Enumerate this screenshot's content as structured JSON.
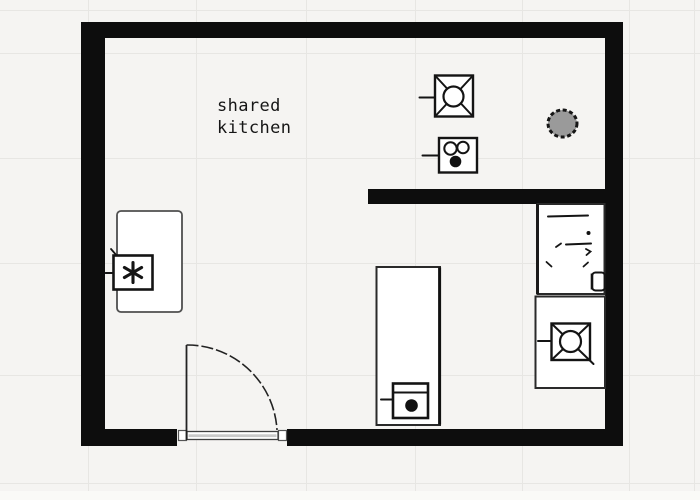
{
  "room_label": {
    "line1": "shared",
    "line2": "kitchen"
  },
  "colors": {
    "background": "#f5f4f2",
    "grid": "#e7e6e3",
    "wall": "#0d0d0d",
    "ink": "#141414",
    "fixture_fill": "#ffffff",
    "door_threshold_fill": "#c9c9c9",
    "column_fill": "#9a9a9a"
  },
  "icons": [
    {
      "name": "light-fixture-icon",
      "shape": "square with X diagonals and centered circle, wall stem"
    },
    {
      "name": "socket-icon",
      "shape": "square with two hollow circles above one filled circle, wall stem"
    },
    {
      "name": "column-icon",
      "shape": "gray circle with dashed black edge"
    },
    {
      "name": "sink-icon",
      "shape": "hand-drawn faucet strokes with small basin square"
    },
    {
      "name": "burner-icon",
      "shape": "square with X diagonals and centered circle, wall stem"
    },
    {
      "name": "asterisk-appliance-icon",
      "shape": "square containing asterisk, wall stem"
    },
    {
      "name": "dot-appliance-icon",
      "shape": "square with top band and filled dot, stem"
    },
    {
      "name": "door-icon",
      "shape": "door leaf with quarter-circle swing arc over threshold"
    }
  ]
}
